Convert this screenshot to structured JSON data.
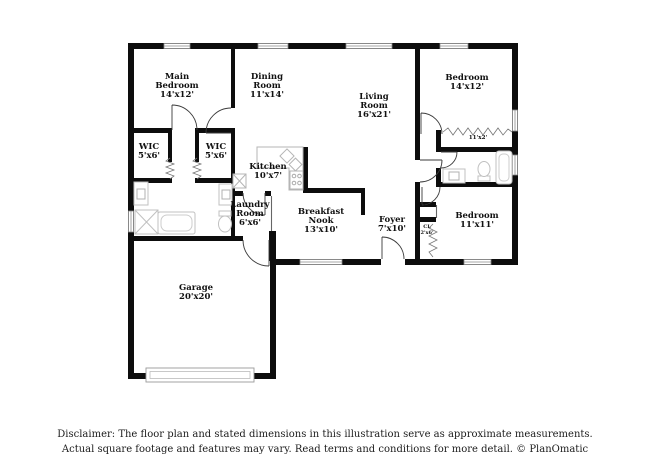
{
  "rooms": [
    {
      "name": "Main Bedroom",
      "dims": "14'x12'"
    },
    {
      "name": "Dining Room",
      "dims": "11'x14'"
    },
    {
      "name": "Living Room",
      "dims": "16'x21'"
    },
    {
      "name": "Bedroom",
      "dims": "14'x12'"
    },
    {
      "name": "WIC",
      "dims": "5'x6'"
    },
    {
      "name": "WIC",
      "dims": "5'x6'"
    },
    {
      "name": "Kitchen",
      "dims": "10'x7'"
    },
    {
      "name": "Laundry Room",
      "dims": "6'x6'"
    },
    {
      "name": "Breakfast Nook",
      "dims": "13'x10'"
    },
    {
      "name": "Foyer",
      "dims": "7'x10'"
    },
    {
      "name": "",
      "dims": "11'x2'"
    },
    {
      "name": "Bedroom",
      "dims": "11'x11'"
    },
    {
      "name": "",
      "dims": "2'x2'"
    },
    {
      "name": "CL",
      "dims": "2'x6'"
    },
    {
      "name": "Garage",
      "dims": "20'x20'"
    }
  ],
  "colors": {
    "wall": "#0d0d0d",
    "fixture": "#c0c0c0",
    "door": "#3a3a3a"
  },
  "disclaimer": {
    "line1": "Disclaimer: The floor plan and stated dimensions in this illustration serve as approximate measurements.",
    "line2": "Actual square footage and features may vary. Read terms and conditions for more detail. © PlanOmatic"
  }
}
